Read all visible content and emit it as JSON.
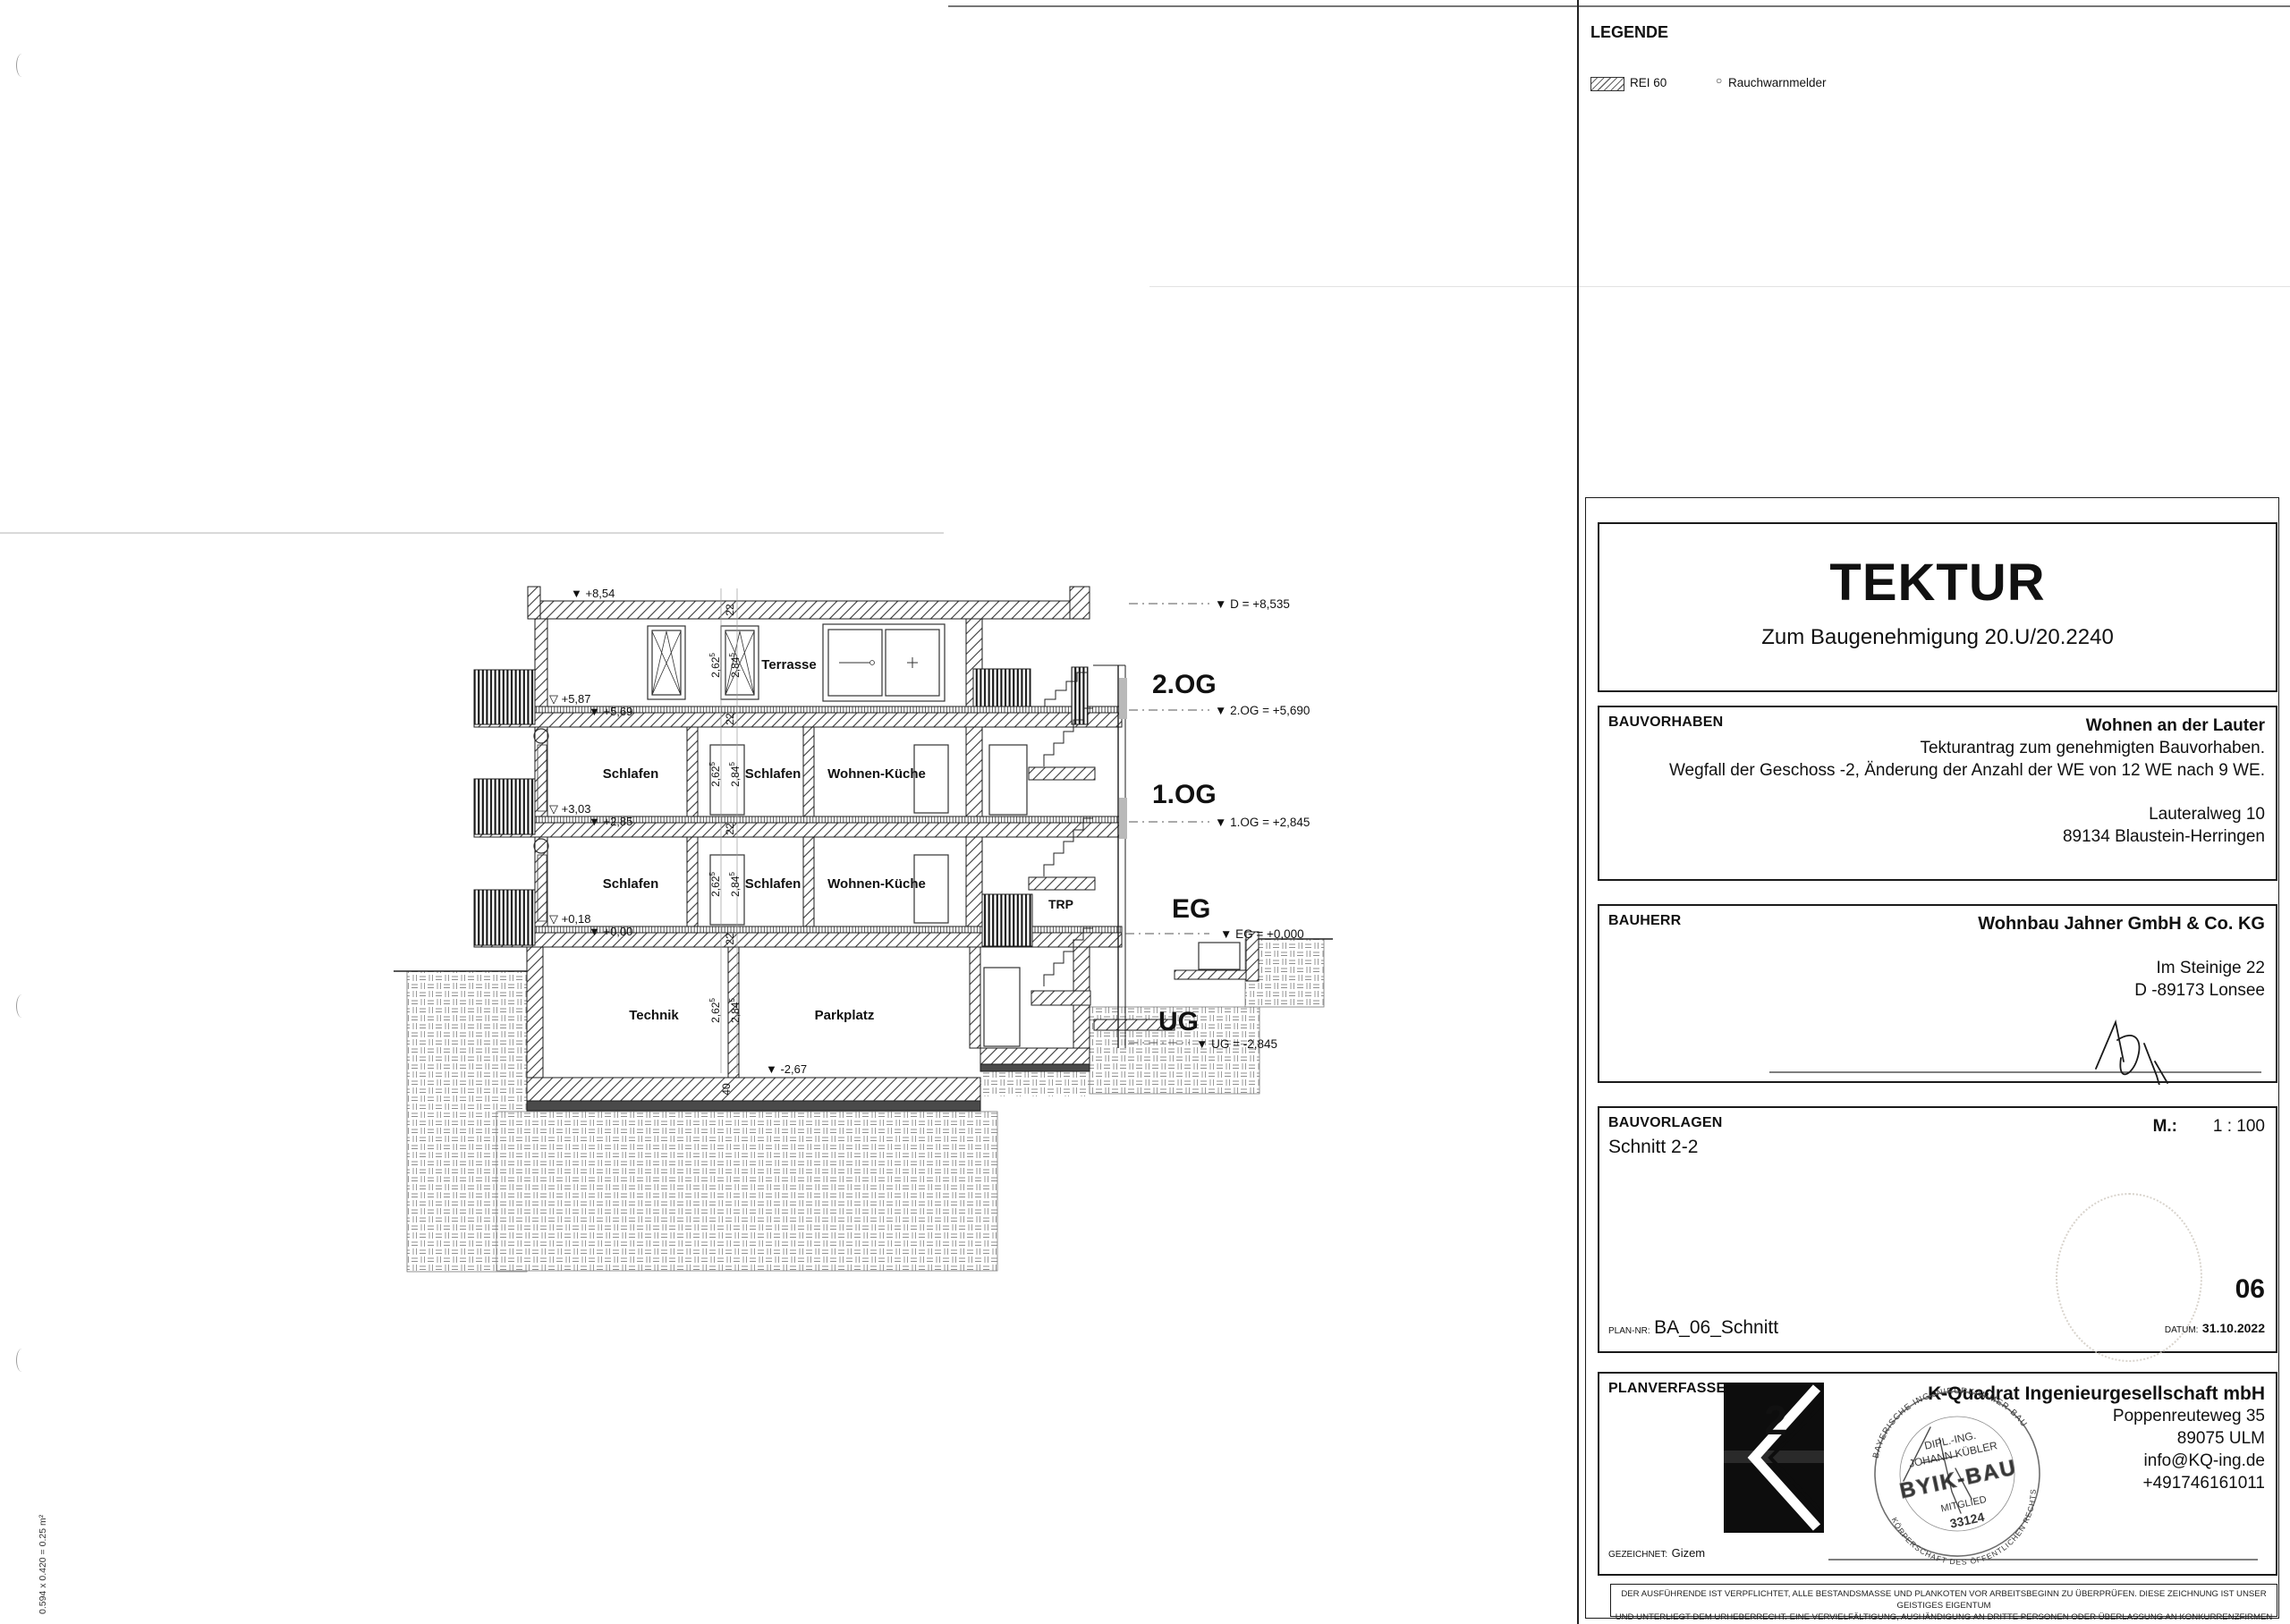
{
  "page": {
    "edge_note": "0.594 x 0.420 = 0.25 m²"
  },
  "legend": {
    "title": "LEGENDE",
    "rei_label": "REI 60",
    "rwm_symbol": "○",
    "rwm_label": "Rauchwarnmelder"
  },
  "drawing": {
    "rooms": {
      "terrasse": "Terrasse",
      "schlafen": "Schlafen",
      "wohnen_kueche": "Wohnen-Küche",
      "technik": "Technik",
      "parkplatz": "Parkplatz",
      "trp": "TRP"
    },
    "floor_labels": {
      "og2": "2.OG",
      "og1": "1.OG",
      "eg": "EG",
      "ug": "UG"
    },
    "level_markers": {
      "d": "▼ D = +8,535",
      "og2": "▼ 2.OG = +5,690",
      "og1": "▼ 1.OG = +2,845",
      "eg": "▼ EG = +0,000",
      "ug": "▼ UG = -2,845"
    },
    "elevations": {
      "roof": "▼ +8,54",
      "t2": "▽ +5,87",
      "f2": "▼ +5,69",
      "t1": "▽ +3,03",
      "f1": "▼ +2,85",
      "t0": "▽ +0,18",
      "f0": "▼ +0,00",
      "ug_floor": "▼ -2,67"
    },
    "dims": {
      "clear": "2,62",
      "floor": "2,84",
      "sup": "5",
      "slab": "22",
      "base": "40"
    }
  },
  "titleblock": {
    "tektur": "TEKTUR",
    "tektur_sub": "Zum Baugenehmigung 20.U/20.2240",
    "bauvorhaben": {
      "label": "BAUVORHABEN",
      "name": "Wohnen an der Lauter",
      "line1": "Tekturantrag zum genehmigten Bauvorhaben.",
      "line2": "Wegfall der Geschoss -2, Änderung der Anzahl der WE von 12 WE nach 9 WE.",
      "street": "Lauteralweg 10",
      "city": "89134  Blaustein-Herringen"
    },
    "bauherr": {
      "label": "BAUHERR",
      "name": "Wohnbau Jahner GmbH & Co. KG",
      "street": "Im Steinige 22",
      "city": "D -89173 Lonsee"
    },
    "bauvorlagen": {
      "label": "BAUVORLAGEN",
      "content": "Schnitt 2-2",
      "scale_label": "M.:",
      "scale": "1 : 100",
      "sheet": "06",
      "plannr_label": "PLAN-NR:",
      "plannr": "BA_06_Schnitt",
      "datum_label": "DATUM:",
      "datum": "31.10.2022"
    },
    "planverfasser": {
      "label": "PLANVERFASSER",
      "logo_sup": "2",
      "firm": "K-Quadrat Ingenieurgesellschaft mbH",
      "street": "Poppenreuteweg 35",
      "city": "89075 ULM",
      "email": "info@KQ-ing.de",
      "phone": "+491746161011",
      "gezeichnet_label": "GEZEICHNET:",
      "gezeichnet": "Gizem"
    },
    "stamp": {
      "ring_top": "BAYERISCHE INGENIEURKAMMER-BAU",
      "ring_bottom": "KÖRPERSCHAFT DES ÖFFENTLICHEN RECHTS",
      "line1": "DIPL.-ING.",
      "line2": "JOHANN KÜBLER",
      "line3": "BYIK-BAU",
      "line4": "MITGLIED",
      "line5": "33124"
    },
    "disclaimer_line1": "DER AUSFÜHRENDE IST VERPFLICHTET, ALLE BESTANDSMASSE UND PLANKOTEN VOR ARBEITSBEGINN ZU ÜBERPRÜFEN. DIESE ZEICHNUNG IST UNSER GEISTIGES EIGENTUM",
    "disclaimer_line2": "UND UNTERLIEGT DEM URHEBERRECHT. EINE VERVIELFÄLTIGUNG, AUSHÄNDIGUNG AN DRITTE PERSONEN ODER ÜBERLASSUNG AN KONKURRENZFIRMEN IST UNTERSAGT."
  }
}
